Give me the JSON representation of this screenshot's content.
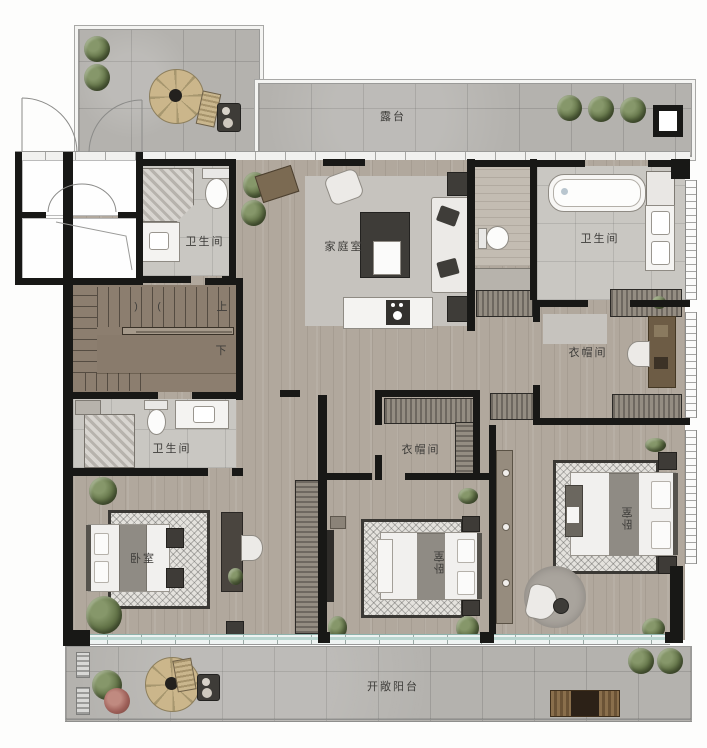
{
  "plan_title": "duplex upper floor plan",
  "rooms": {
    "terrace": {
      "label": "露台"
    },
    "family_room": {
      "label": "家庭室"
    },
    "bathroom_top_left": {
      "label": "卫生间"
    },
    "bathroom_top_right": {
      "label": "卫生间"
    },
    "bathroom_mid_left": {
      "label": "卫生间"
    },
    "cloakroom_right": {
      "label": "衣帽间"
    },
    "cloakroom_mid": {
      "label": "衣帽间"
    },
    "bedroom_left": {
      "label": "卧室"
    },
    "bedroom_mid": {
      "label": "卧室"
    },
    "bedroom_right": {
      "label": "卧室"
    },
    "open_balcony": {
      "label": "开敞阳台"
    }
  },
  "stairs": {
    "up_label": "上",
    "down_label": "下",
    "arrow_left": ")",
    "arrow_right": "("
  },
  "palette": {
    "wall": "#181816",
    "wood_floor": "#b1a89d",
    "outdoor_tile": "#b4b2ae",
    "bath_tile": "#c9c7c2",
    "stair_floor": "#8c7e6f",
    "window_teal": "#b9d6d0",
    "plant_green": "#64744a",
    "label_text": "#3e3d3a"
  }
}
